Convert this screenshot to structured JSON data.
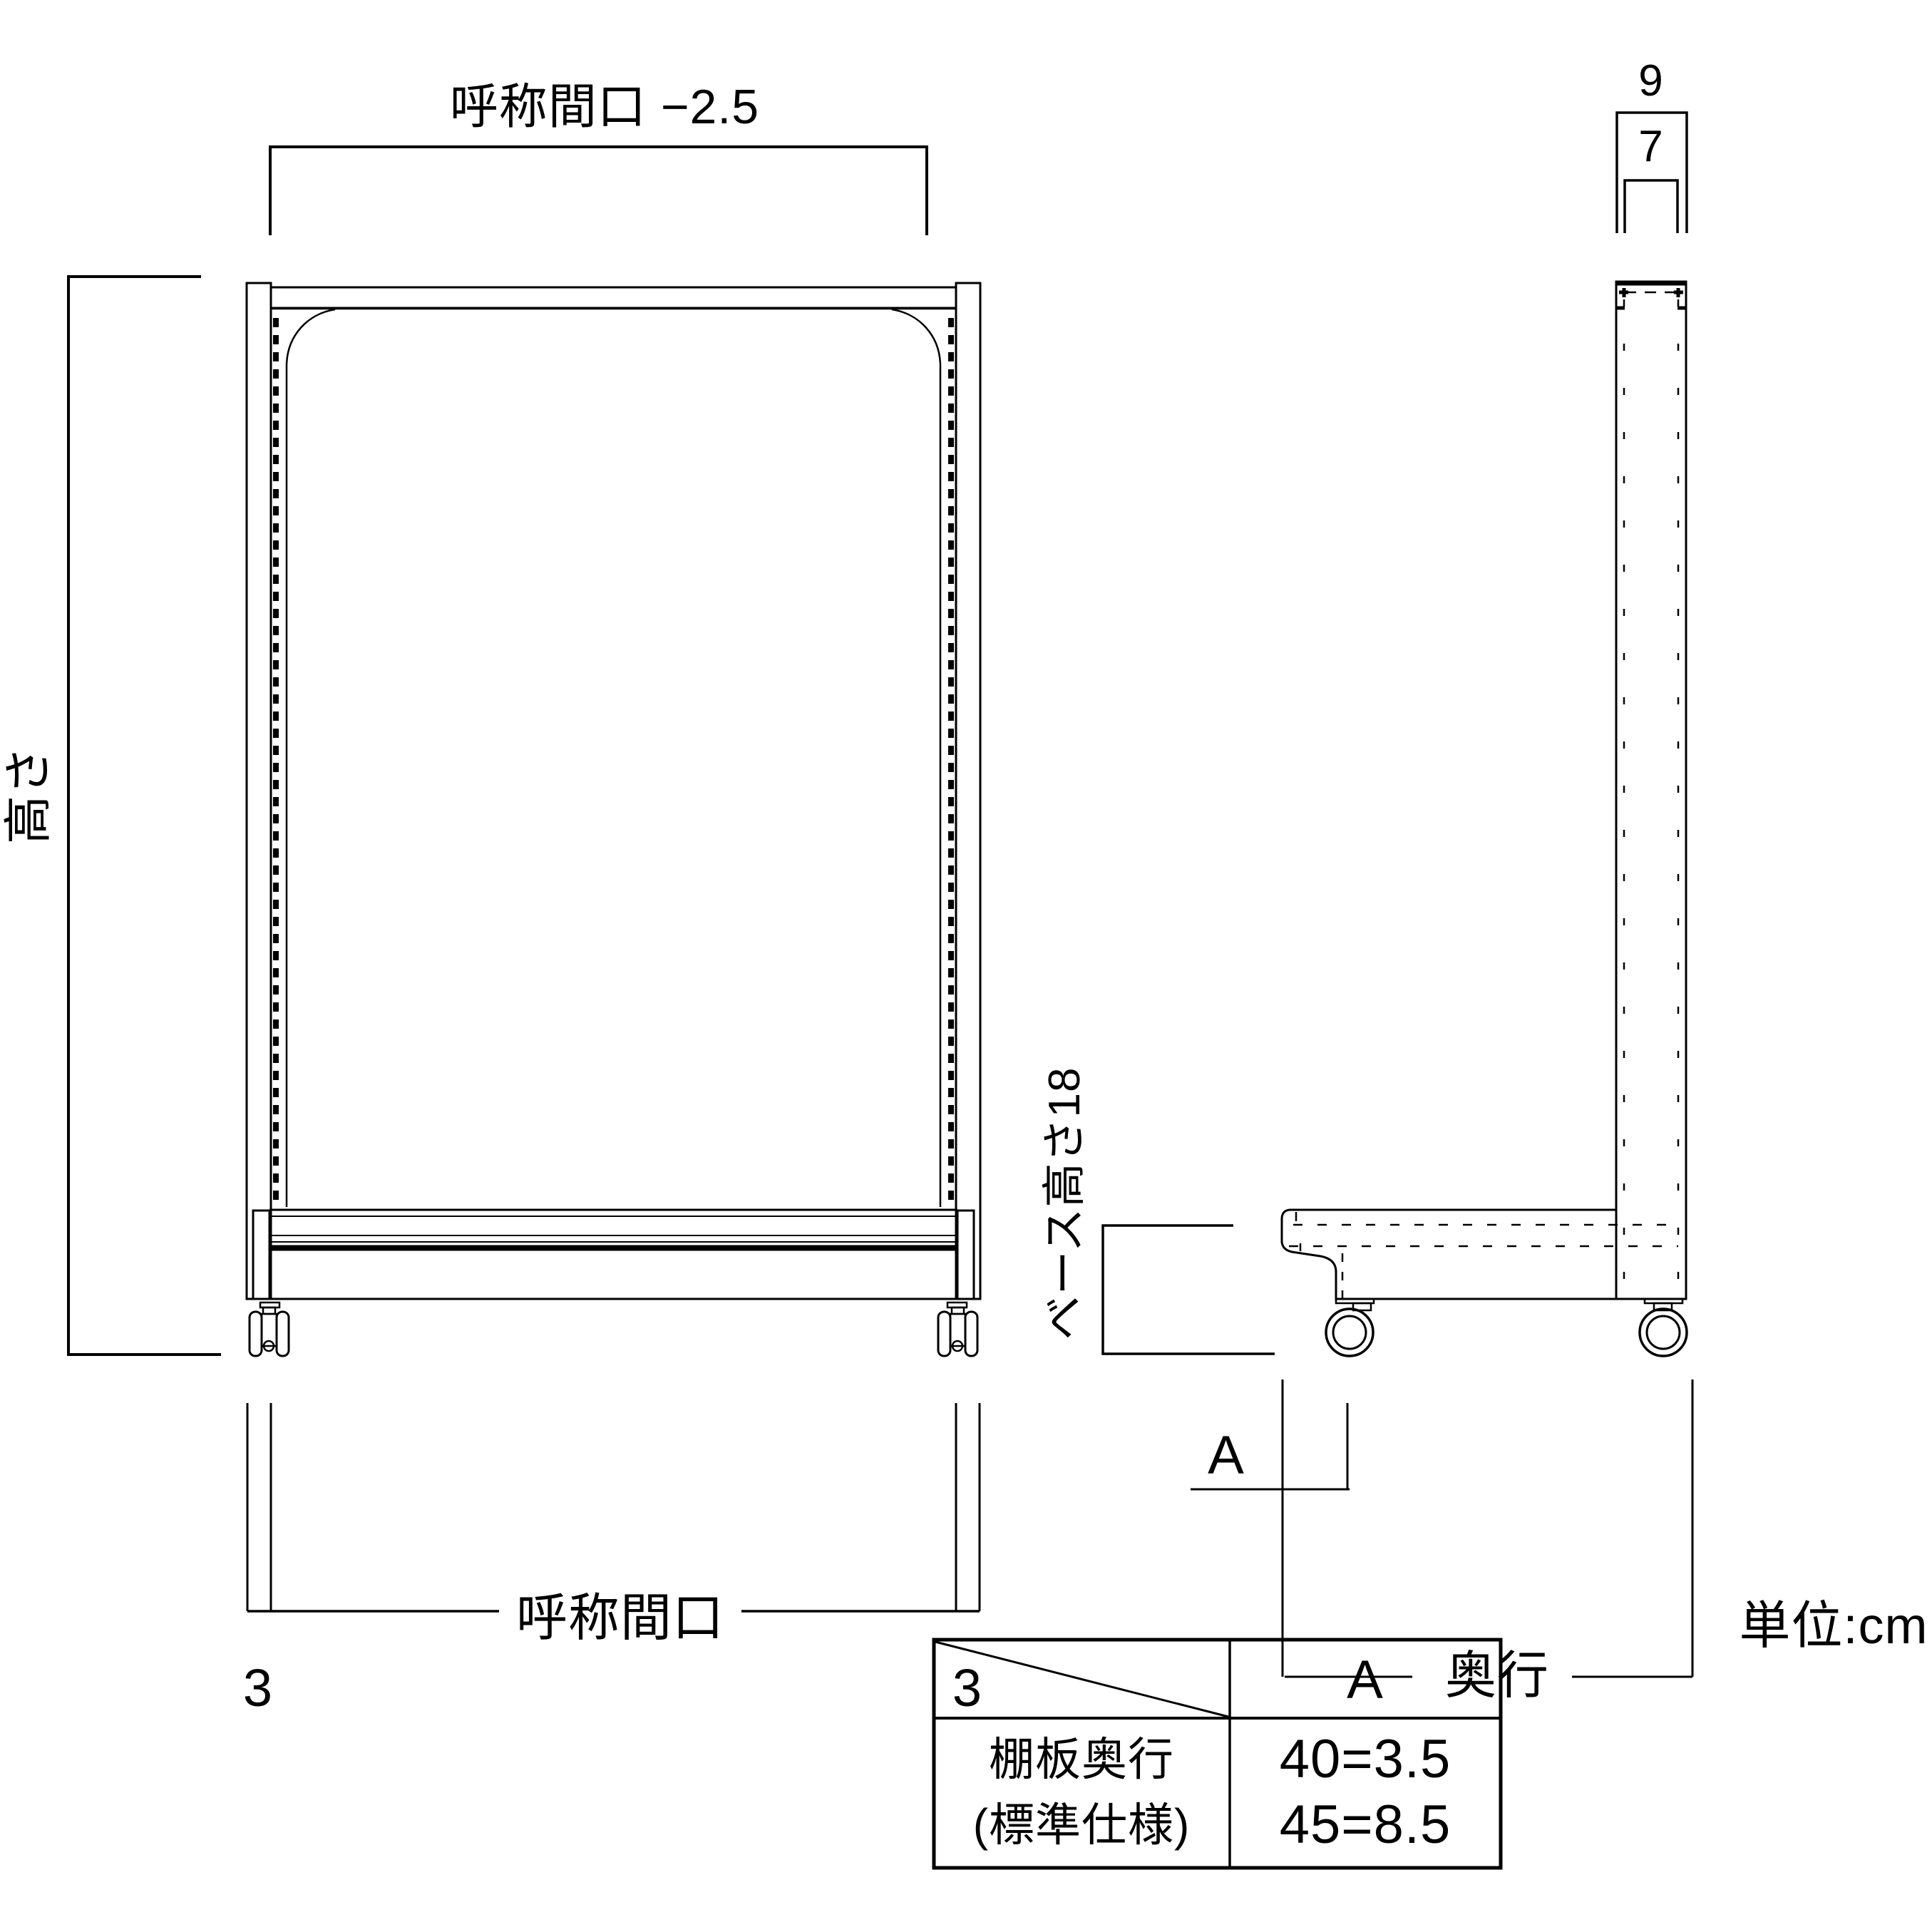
{
  "diagram": {
    "unit_note": "単位:cm",
    "front_view": {
      "top_width_dim": "呼称間口 −2.5",
      "height_dim": "高さ",
      "bottom_width_dim": "呼称間口",
      "bottom_left_offset": "3",
      "bottom_right_offset": "3"
    },
    "side_view": {
      "outer_width_dim": "9",
      "inner_width_dim": "7",
      "base_height_dim": "ベース高さ18",
      "a_dim": "A",
      "depth_dim": "奥行"
    },
    "spec_table": {
      "col_header": "A",
      "row_header_line1": "棚板奥行",
      "row_header_line2": "(標準仕様)",
      "value_line1": "40=3.5",
      "value_line2": "45=8.5"
    },
    "colors": {
      "line": "#000000",
      "background": "#ffffff"
    }
  }
}
